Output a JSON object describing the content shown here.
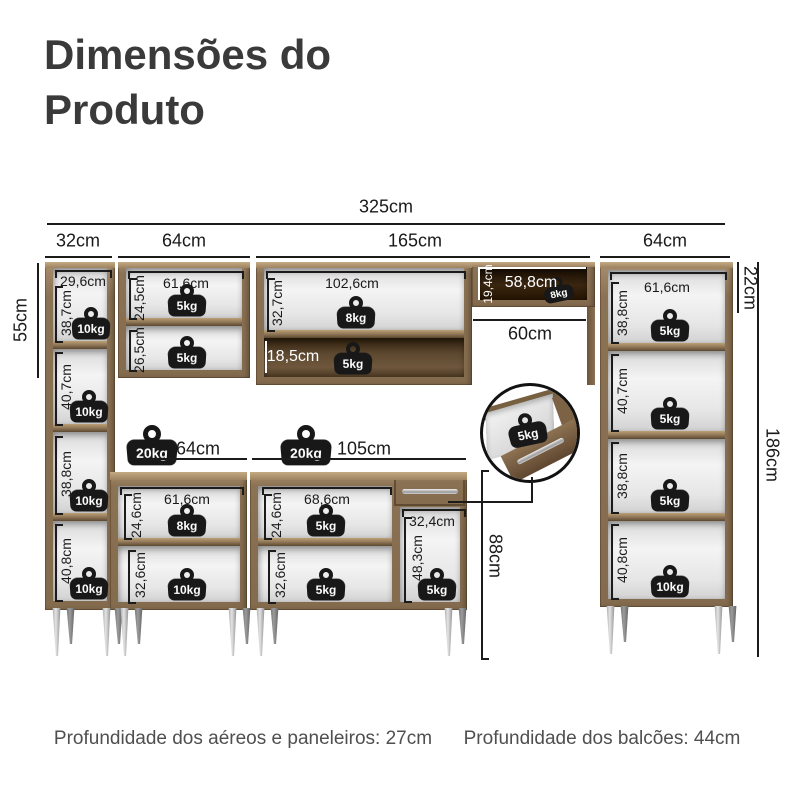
{
  "title": "Dimensões do Produto",
  "footer": {
    "aereos": "Profundidade dos aéreos e paneleiros: 27cm",
    "balcoes": "Profundidade dos balcões: 44cm"
  },
  "weights": {
    "w5": "5kg",
    "w8": "8kg",
    "w10": "10kg",
    "w20": "20kg"
  },
  "dims": {
    "total_width": "325cm",
    "p1_width": "32cm",
    "a1_width": "64cm",
    "a2_width": "165cm",
    "p2_width": "64cm",
    "p1_top_height": "55cm",
    "p1_inner_width": "29,6cm",
    "p1_s1": "38,7cm",
    "p1_s2": "40,7cm",
    "p1_s3": "38,8cm",
    "p1_s4": "40,8cm",
    "a1_inner_width": "61,6cm",
    "a1_s1": "24,5cm",
    "a1_s2": "26,5cm",
    "a2_inner_width": "102,6cm",
    "a2_s1": "32,7cm",
    "a2_s2": "18,5cm",
    "hood_height": "19,4cm",
    "hood_width": "58,8cm",
    "stove_gap": "60cm",
    "p2_top": "22cm",
    "total_height": "186cm",
    "p2_inner_width": "61,6cm",
    "p2_s1": "38,8cm",
    "p2_s2": "40,7cm",
    "p2_s3": "38,8cm",
    "p2_s4": "40,8cm",
    "b1_width": "64cm",
    "b2_width": "105cm",
    "b_height": "88cm",
    "b1_inner_width": "61,6cm",
    "b1_s1": "24,6cm",
    "b1_s2": "32,6cm",
    "b2_inner_width": "68,6cm",
    "b2_s1": "24,6cm",
    "b2_s2": "32,6cm",
    "b2_niche_width": "32,4cm",
    "b2_niche_height": "48,3cm"
  },
  "colors": {
    "wood": "#8b7254",
    "line": "#1b1b1b",
    "weight": "#181818"
  }
}
